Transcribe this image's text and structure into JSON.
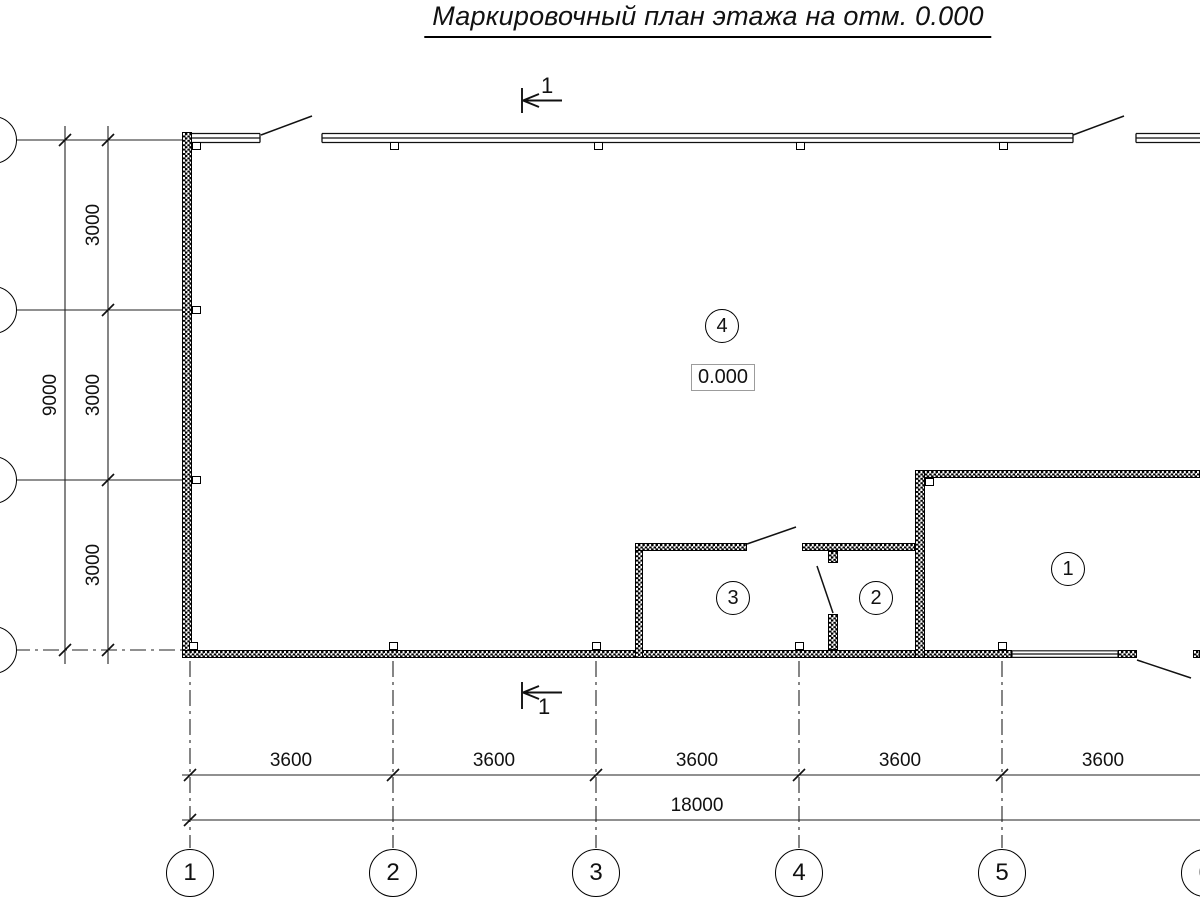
{
  "title": "Маркировочный план этажа на отм. 0.000",
  "elevation": {
    "value": "0.000"
  },
  "rooms": {
    "r1": "1",
    "r2": "2",
    "r3": "3",
    "r4": "4"
  },
  "section": {
    "top": "1",
    "bottom": "1"
  },
  "dims": {
    "bays": [
      "3600",
      "3600",
      "3600",
      "3600",
      "3600"
    ],
    "total_width": "18000",
    "rows": [
      "3000",
      "3000",
      "3000"
    ],
    "total_height": "9000"
  },
  "grid": {
    "columns": [
      "1",
      "2",
      "3",
      "4",
      "5",
      "6"
    ]
  },
  "colors": {
    "ink": "#000000",
    "paper": "#ffffff",
    "elevation_box_border": "#9c9c9c"
  }
}
